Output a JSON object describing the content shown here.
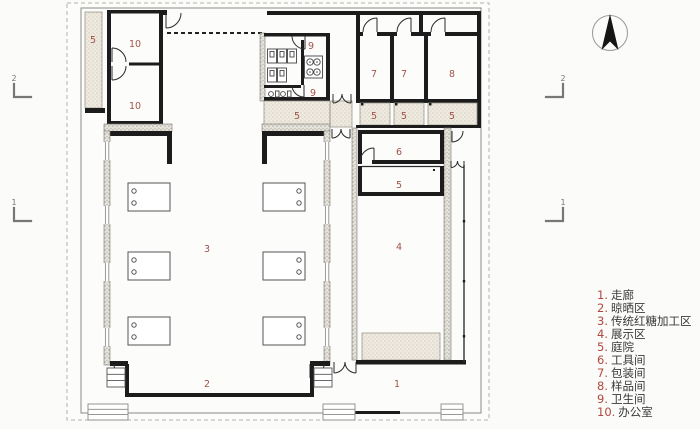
{
  "colors": {
    "room_label": "#a3524a",
    "legend_number": "#b0483f",
    "legend_text": "#3a3a3a",
    "wall": "#1c1c1c",
    "courtyard_fill": "#efeadf",
    "stone_fill": "#e5e2da"
  },
  "plan": {
    "room_labels": [
      {
        "name": "courtyard-nw",
        "text": "5"
      },
      {
        "name": "office-top",
        "text": "10"
      },
      {
        "name": "office-bottom",
        "text": "10"
      },
      {
        "name": "wc-top",
        "text": "9"
      },
      {
        "name": "wc-bottom",
        "text": "9"
      },
      {
        "name": "courtyard-wc",
        "text": "5"
      },
      {
        "name": "packing-a",
        "text": "7"
      },
      {
        "name": "packing-b",
        "text": "7"
      },
      {
        "name": "sample",
        "text": "8"
      },
      {
        "name": "courtyard-a",
        "text": "5"
      },
      {
        "name": "courtyard-b",
        "text": "5"
      },
      {
        "name": "courtyard-c",
        "text": "5"
      },
      {
        "name": "tools",
        "text": "6"
      },
      {
        "name": "courtyard-mid",
        "text": "5"
      },
      {
        "name": "exhibition",
        "text": "4"
      },
      {
        "name": "processing",
        "text": "3"
      },
      {
        "name": "drying",
        "text": "2"
      },
      {
        "name": "corridor",
        "text": "1"
      }
    ],
    "section_markers": [
      {
        "side": "left-top",
        "label": "2"
      },
      {
        "side": "left-bottom",
        "label": "1"
      },
      {
        "side": "right-top",
        "label": "2"
      },
      {
        "side": "right-bottom",
        "label": "1"
      }
    ],
    "north_arrow_icon": "north-arrow"
  },
  "legend": {
    "items": [
      {
        "num": "1.",
        "label": "走廊"
      },
      {
        "num": "2.",
        "label": "晾晒区"
      },
      {
        "num": "3.",
        "label": "传统红糖加工区"
      },
      {
        "num": "4.",
        "label": "展示区"
      },
      {
        "num": "5.",
        "label": "庭院"
      },
      {
        "num": "6.",
        "label": "工具间"
      },
      {
        "num": "7.",
        "label": "包装间"
      },
      {
        "num": "8.",
        "label": "样品间"
      },
      {
        "num": "9.",
        "label": "卫生间"
      },
      {
        "num": "10.",
        "label": "办公室"
      }
    ]
  }
}
